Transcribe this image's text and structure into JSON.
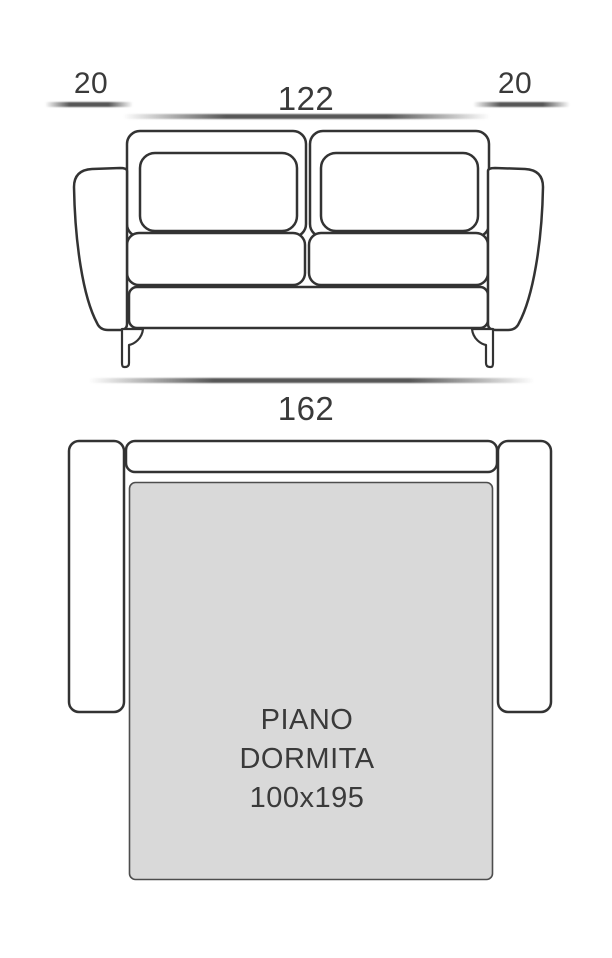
{
  "title": "Sofa bed dimensions diagram",
  "front_view": {
    "left_armrest_width_label": "20",
    "seat_width_label": "122",
    "right_armrest_width_label": "20",
    "total_width_label": "162"
  },
  "top_view": {
    "sleeping_area_label": [
      "PIANO",
      "DORMITA",
      "100x195"
    ]
  },
  "colors": {
    "outline": "#333333",
    "text": "#3a3a3a",
    "mattress_fill": "#d9d9d9",
    "mattress_stroke": "#4d4d4d",
    "dim_bar": "#565656",
    "background": "#ffffff"
  }
}
